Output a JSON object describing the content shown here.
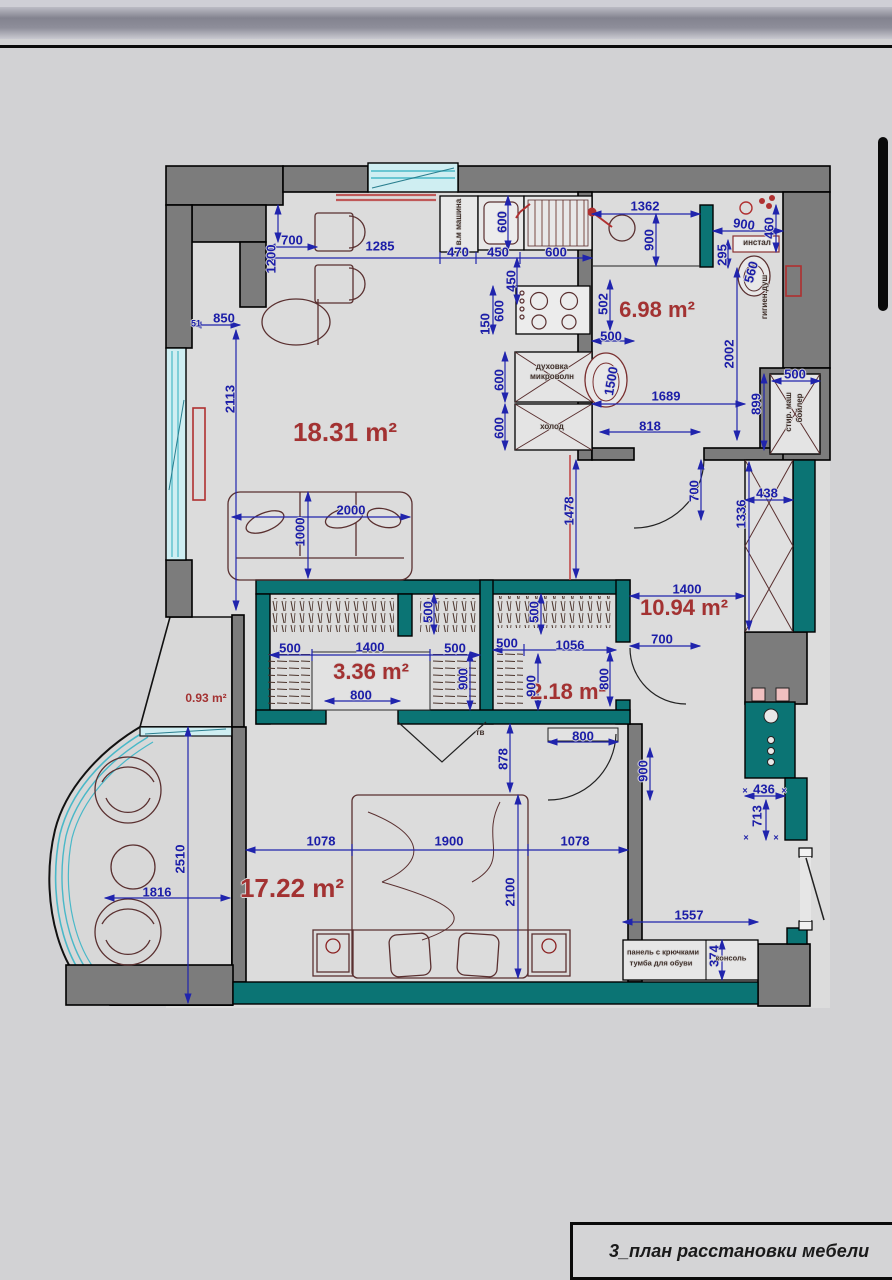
{
  "title_block": {
    "label": "3_план расстановки мебели"
  },
  "colors": {
    "dimension_blue": "#1b1da8",
    "area_label_red": "#a33232",
    "wall_gray": "#7c7c7c",
    "partition_teal": "#0b7474",
    "glazing_cyan": "#49b8c8",
    "furniture_outline": "#5a3030",
    "fixture_red": "#b03030"
  },
  "rooms": [
    {
      "name": "living-kitchen",
      "area_label": "18.31 m²"
    },
    {
      "name": "bathroom",
      "area_label": "6.98 m²"
    },
    {
      "name": "hallway",
      "area_label": "10.94 m²"
    },
    {
      "name": "wardrobe",
      "area_label": "3.36 m²"
    },
    {
      "name": "closet",
      "area_label": "2.18 m²"
    },
    {
      "name": "bedroom",
      "area_label": "17.22 m²"
    },
    {
      "name": "balcony",
      "area_label": "0.93 m²"
    }
  ],
  "annotations": [
    {
      "n": "dim-dining-width",
      "t": "700",
      "x": 292,
      "y": 240,
      "c": "dim"
    },
    {
      "n": "dim-dining-depth",
      "t": "1200",
      "x": 271,
      "y": 259,
      "r": -90,
      "c": "dim"
    },
    {
      "n": "dim-kitchen-run",
      "t": "1285",
      "x": 380,
      "y": 246,
      "c": "dim"
    },
    {
      "n": "dim-washer-width",
      "t": "470",
      "x": 458,
      "y": 252,
      "c": "dim"
    },
    {
      "n": "dim-sink-cabinet",
      "t": "450",
      "x": 498,
      "y": 252,
      "c": "dim"
    },
    {
      "n": "dim-sink-top",
      "t": "600",
      "x": 556,
      "y": 252,
      "c": "dim"
    },
    {
      "n": "dim-sink-depth",
      "t": "600",
      "x": 502,
      "y": 222,
      "r": -90,
      "c": "dim"
    },
    {
      "n": "dim-counter-depth",
      "t": "450",
      "x": 511,
      "y": 281,
      "r": -90,
      "c": "dim"
    },
    {
      "n": "dim-niche-850",
      "t": "850",
      "x": 224,
      "y": 318,
      "c": "dim"
    },
    {
      "n": "dim-niche-51",
      "t": "51",
      "x": 196,
      "y": 324,
      "c": "dim-sm"
    },
    {
      "n": "dim-living-2113",
      "t": "2113",
      "x": 230,
      "y": 399,
      "r": -90,
      "c": "dim"
    },
    {
      "n": "dim-hob-150",
      "t": "150",
      "x": 485,
      "y": 324,
      "r": -90,
      "c": "dim"
    },
    {
      "n": "dim-hob-600",
      "t": "600",
      "x": 499,
      "y": 311,
      "r": -90,
      "c": "dim"
    },
    {
      "n": "dim-oven-600",
      "t": "600",
      "x": 499,
      "y": 380,
      "r": -90,
      "c": "dim"
    },
    {
      "n": "dim-fridge-600",
      "t": "600",
      "x": 499,
      "y": 428,
      "r": -90,
      "c": "dim"
    },
    {
      "n": "lbl-washing-machine",
      "t": "в.м машина",
      "x": 459,
      "y": 222,
      "r": -90,
      "c": "lbl"
    },
    {
      "n": "lbl-oven",
      "t": "духовка",
      "x": 552,
      "y": 367,
      "c": "lbl"
    },
    {
      "n": "lbl-microwave",
      "t": "микроволн",
      "x": 552,
      "y": 377,
      "c": "lbl"
    },
    {
      "n": "lbl-fridge",
      "t": "холод",
      "x": 552,
      "y": 427,
      "c": "lbl"
    },
    {
      "n": "dim-bath-1362",
      "t": "1362",
      "x": 645,
      "y": 206,
      "c": "dim"
    },
    {
      "n": "dim-bath-900v",
      "t": "900",
      "x": 649,
      "y": 240,
      "r": -90,
      "c": "dim"
    },
    {
      "n": "dim-wc-900",
      "t": "900",
      "x": 744,
      "y": 224,
      "r": 8,
      "c": "dim"
    },
    {
      "n": "dim-wc-460",
      "t": "460",
      "x": 769,
      "y": 228,
      "r": -90,
      "c": "dim"
    },
    {
      "n": "lbl-instal",
      "t": "инстал",
      "x": 757,
      "y": 243,
      "c": "lbl"
    },
    {
      "n": "dim-wc-295",
      "t": "295",
      "x": 722,
      "y": 255,
      "r": -90,
      "c": "dim"
    },
    {
      "n": "dim-toilet-560",
      "t": "560",
      "x": 751,
      "y": 272,
      "r": -75,
      "c": "dim"
    },
    {
      "n": "lbl-hygiene-shower",
      "t": "гигиен.душ",
      "x": 765,
      "y": 297,
      "r": -90,
      "c": "lbl"
    },
    {
      "n": "dim-bath-502",
      "t": "502",
      "x": 603,
      "y": 304,
      "r": -90,
      "c": "dim"
    },
    {
      "n": "dim-bath-500",
      "t": "500",
      "x": 611,
      "y": 336,
      "c": "dim"
    },
    {
      "n": "dim-bathsink-1500",
      "t": "1500",
      "x": 611,
      "y": 381,
      "r": -80,
      "c": "dim"
    },
    {
      "n": "dim-bath-2002",
      "t": "2002",
      "x": 729,
      "y": 354,
      "r": -90,
      "c": "dim"
    },
    {
      "n": "dim-bath-1689",
      "t": "1689",
      "x": 666,
      "y": 396,
      "c": "dim"
    },
    {
      "n": "dim-bath-899",
      "t": "899",
      "x": 756,
      "y": 404,
      "r": -90,
      "c": "dim"
    },
    {
      "n": "dim-bath-818",
      "t": "818",
      "x": 650,
      "y": 426,
      "c": "dim"
    },
    {
      "n": "dim-boiler-500",
      "t": "500",
      "x": 795,
      "y": 374,
      "c": "dim"
    },
    {
      "n": "lbl-laundry",
      "t": "стир. маш",
      "x": 789,
      "y": 412,
      "r": -90,
      "c": "lbl"
    },
    {
      "n": "lbl-boiler",
      "t": "бойлер",
      "x": 800,
      "y": 408,
      "r": -90,
      "c": "lbl"
    },
    {
      "n": "dim-hall-1478",
      "t": "1478",
      "x": 569,
      "y": 511,
      "r": -90,
      "c": "dim"
    },
    {
      "n": "dim-bathdoor-700",
      "t": "700",
      "x": 694,
      "y": 491,
      "r": -90,
      "c": "dim"
    },
    {
      "n": "dim-shaft-1336",
      "t": "1336",
      "x": 741,
      "y": 514,
      "r": -90,
      "c": "dim"
    },
    {
      "n": "dim-shaft-438",
      "t": "438",
      "x": 767,
      "y": 493,
      "c": "dim"
    },
    {
      "n": "dim-hall-1400",
      "t": "1400",
      "x": 687,
      "y": 589,
      "c": "dim"
    },
    {
      "n": "dim-halldoor-700",
      "t": "700",
      "x": 662,
      "y": 639,
      "c": "dim"
    },
    {
      "n": "area-living",
      "t": "18.31 m²",
      "x": 345,
      "y": 432,
      "c": "area-lg"
    },
    {
      "n": "area-bathroom",
      "t": "6.98 m²",
      "x": 657,
      "y": 310,
      "c": "area"
    },
    {
      "n": "area-hallway",
      "t": "10.94 m²",
      "x": 684,
      "y": 608,
      "c": "area"
    },
    {
      "n": "area-wardrobe",
      "t": "3.36 m²",
      "x": 371,
      "y": 672,
      "c": "area"
    },
    {
      "n": "area-closet",
      "t": "2.18 m²",
      "x": 568,
      "y": 692,
      "c": "area"
    },
    {
      "n": "area-bedroom",
      "t": "17.22 m²",
      "x": 292,
      "y": 888,
      "c": "area-lg"
    },
    {
      "n": "area-balcony",
      "t": "0.93 m²",
      "x": 206,
      "y": 698,
      "c": "area-sm"
    },
    {
      "n": "dim-wardrobe-500a",
      "t": "500",
      "x": 290,
      "y": 648,
      "c": "dim"
    },
    {
      "n": "dim-wardrobe-1400",
      "t": "1400",
      "x": 370,
      "y": 647,
      "c": "dim"
    },
    {
      "n": "dim-wardrobe-500b",
      "t": "500",
      "x": 455,
      "y": 648,
      "c": "dim"
    },
    {
      "n": "dim-wardrobe-500v",
      "t": "500",
      "x": 428,
      "y": 612,
      "r": -90,
      "c": "dim"
    },
    {
      "n": "dim-wardrobe-900v",
      "t": "900",
      "x": 463,
      "y": 679,
      "r": -90,
      "c": "dim"
    },
    {
      "n": "dim-wardrobe-800",
      "t": "800",
      "x": 361,
      "y": 695,
      "c": "dim"
    },
    {
      "n": "dim-closet-500v",
      "t": "500",
      "x": 534,
      "y": 612,
      "r": -90,
      "c": "dim"
    },
    {
      "n": "dim-closet-500",
      "t": "500",
      "x": 507,
      "y": 643,
      "c": "dim"
    },
    {
      "n": "dim-closet-1056",
      "t": "1056",
      "x": 570,
      "y": 645,
      "c": "dim"
    },
    {
      "n": "dim-closet-900v",
      "t": "900",
      "x": 531,
      "y": 686,
      "r": -90,
      "c": "dim"
    },
    {
      "n": "dim-closet-800v",
      "t": "800",
      "x": 604,
      "y": 679,
      "r": -90,
      "c": "dim"
    },
    {
      "n": "lbl-tv",
      "t": "тв",
      "x": 480,
      "y": 733,
      "c": "lbl"
    },
    {
      "n": "dim-bed-878",
      "t": "878",
      "x": 503,
      "y": 759,
      "r": -90,
      "c": "dim"
    },
    {
      "n": "dim-beddoor-800",
      "t": "800",
      "x": 583,
      "y": 736,
      "c": "dim"
    },
    {
      "n": "dim-beddoor-900",
      "t": "900",
      "x": 643,
      "y": 771,
      "r": -90,
      "c": "dim"
    },
    {
      "n": "dim-bed-1078a",
      "t": "1078",
      "x": 321,
      "y": 841,
      "c": "dim"
    },
    {
      "n": "dim-bed-1900",
      "t": "1900",
      "x": 449,
      "y": 841,
      "c": "dim"
    },
    {
      "n": "dim-bed-1078b",
      "t": "1078",
      "x": 575,
      "y": 841,
      "c": "dim"
    },
    {
      "n": "dim-bed-2100",
      "t": "2100",
      "x": 510,
      "y": 892,
      "r": -90,
      "c": "dim"
    },
    {
      "n": "dim-sofa-2000",
      "t": "2000",
      "x": 351,
      "y": 510,
      "c": "dim"
    },
    {
      "n": "dim-sofa-1000",
      "t": "1000",
      "x": 300,
      "y": 532,
      "r": -90,
      "c": "dim"
    },
    {
      "n": "dim-entry-1557",
      "t": "1557",
      "x": 689,
      "y": 915,
      "c": "dim"
    },
    {
      "n": "dim-entry-374",
      "t": "374",
      "x": 714,
      "y": 956,
      "r": -90,
      "c": "dim"
    },
    {
      "n": "lbl-hook-panel",
      "t": "панель с крючками",
      "x": 663,
      "y": 952,
      "c": "lbl-sm"
    },
    {
      "n": "lbl-shoe-cabinet",
      "t": "тумба для обуви",
      "x": 661,
      "y": 963,
      "c": "lbl-sm"
    },
    {
      "n": "lbl-console",
      "t": "консоль",
      "x": 731,
      "y": 958,
      "c": "lbl-sm"
    },
    {
      "n": "dim-shaft-436",
      "t": "436",
      "x": 764,
      "y": 789,
      "c": "dim"
    },
    {
      "n": "dim-shaft-713",
      "t": "713",
      "x": 757,
      "y": 816,
      "r": -90,
      "c": "dim"
    },
    {
      "n": "x-mark-1",
      "t": "×",
      "x": 745,
      "y": 791,
      "c": "dim-sm"
    },
    {
      "n": "x-mark-2",
      "t": "×",
      "x": 784,
      "y": 791,
      "c": "dim-sm"
    },
    {
      "n": "x-mark-3",
      "t": "×",
      "x": 746,
      "y": 838,
      "c": "dim-sm"
    },
    {
      "n": "x-mark-4",
      "t": "×",
      "x": 776,
      "y": 838,
      "c": "dim-sm"
    },
    {
      "n": "dim-balcony-2510",
      "t": "2510",
      "x": 180,
      "y": 859,
      "r": -90,
      "c": "dim"
    },
    {
      "n": "dim-balcony-1816",
      "t": "1816",
      "x": 157,
      "y": 892,
      "c": "dim"
    }
  ]
}
